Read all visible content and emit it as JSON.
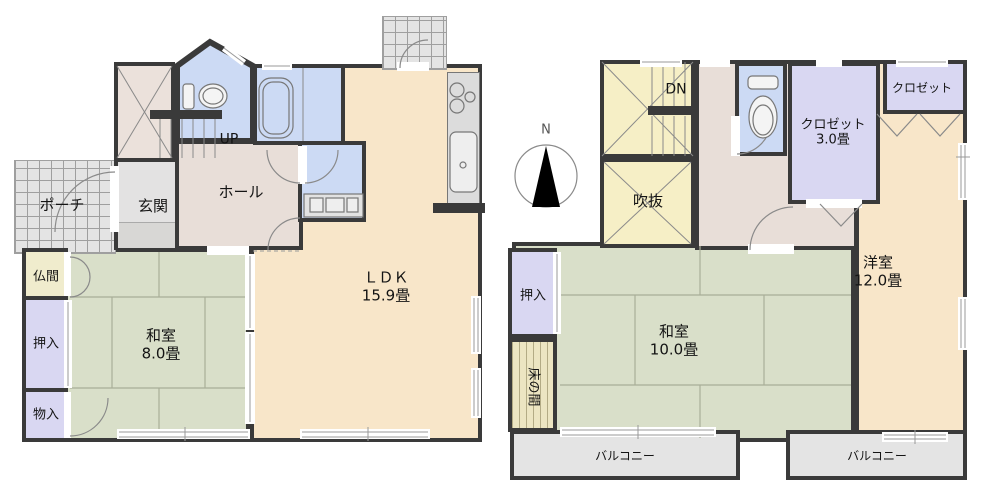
{
  "fp": {
    "floor1": {
      "porch": {
        "label": "ポーチ"
      },
      "genkan": {
        "label": "玄関"
      },
      "hall": {
        "label": "ホール"
      },
      "stairs": {
        "label": "UP"
      },
      "butsuma": {
        "label": "仏間"
      },
      "oshiire": {
        "label": "押入"
      },
      "monoire": {
        "label": "物入"
      },
      "washitsu": {
        "label": "和室",
        "size": "8.0畳"
      },
      "ldk": {
        "label": "ＬＤＫ",
        "size": "15.9畳"
      }
    },
    "floor2": {
      "stairs": {
        "label": "DN"
      },
      "atrium": {
        "label": "吹抜"
      },
      "closet": {
        "label": "クロゼット",
        "size": "3.0畳"
      },
      "closet2": {
        "label": "クロゼット"
      },
      "yoshitsu": {
        "label": "洋室",
        "size": "12.0畳"
      },
      "washitsu": {
        "label": "和室",
        "size": "10.0畳"
      },
      "oshiire": {
        "label": "押入"
      },
      "tokonoma": {
        "label": "床の間"
      },
      "balcony_left": {
        "label": "バルコニー"
      },
      "balcony_right": {
        "label": "バルコニー"
      }
    },
    "compass": {
      "label": "N"
    },
    "colors": {
      "wall": "#3a3a3a",
      "tatami_room": "#d9dfc9",
      "wood_room": "#f8e6c9",
      "closet": "#d9d7f2",
      "wet_area": "#ccdaf4",
      "stair_atrium": "#f6efc6",
      "hall": "#e8ded8",
      "tile_porch": "#e4e4e4",
      "balcony": "#e4e4e4",
      "tokonoma": "#ece5c2"
    }
  }
}
